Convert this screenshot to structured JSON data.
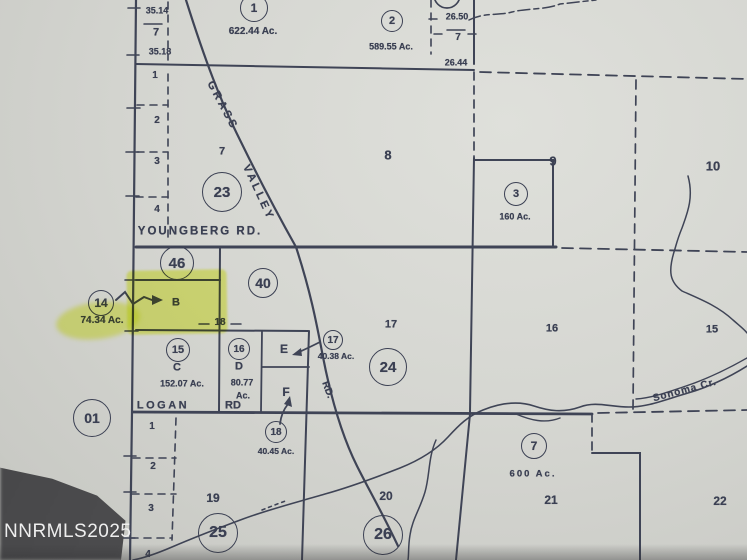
{
  "watermark": "NNRMLS2025",
  "colors": {
    "paper": "#d5d6d1",
    "ink": "#3b4053",
    "highlight": "#e9f63e",
    "photo_corner": "#4f4f51",
    "watermark_text": "#eeeeee"
  },
  "map": {
    "roads": {
      "youngberg": "YOUNGBERG  RD.",
      "grass": "GRASS",
      "valley": "VALLEY",
      "valley_rd": "RD.",
      "logan": "LOGAN",
      "logan_rd": "RD"
    },
    "creek_label": "Sonoma Cr.",
    "sections": {
      "s7": "7",
      "s8": "8",
      "s9": "9",
      "s10": "10",
      "s15": "15",
      "s16": "16",
      "s17": "17",
      "s19": "19",
      "s20": "20",
      "s21": "21",
      "s22": "22"
    },
    "circled": {
      "c1": "1",
      "c2": "2",
      "c3": "3",
      "c7": "7",
      "c01": "01",
      "c14": "14",
      "c15": "15",
      "c16": "16",
      "c17": "17",
      "c18": "18",
      "c23": "23",
      "c24": "24",
      "c25": "25",
      "c26": "26",
      "c40": "40",
      "c46": "46"
    },
    "acreage": {
      "a622": "622.44 Ac.",
      "a589": "589.55 Ac.",
      "a160": "160 Ac.",
      "a74": "74.34 Ac.",
      "a152": "152.07 Ac.",
      "a80": "80.77",
      "a80u": "Ac.",
      "a4038": "40.38 Ac.",
      "a4045": "40.45 Ac.",
      "a600": "600 Ac."
    },
    "lot_dims": {
      "d3514": "35.14",
      "d7top": "7",
      "d3518": "35.18",
      "d2650": "26.50",
      "d7r": "7",
      "d2644": "26.44",
      "edge18": "18"
    },
    "lot_numbers": {
      "u1": "1",
      "u2": "2",
      "u3": "3",
      "u4": "4",
      "w1": "1",
      "w2": "2",
      "w3": "3",
      "w4": "4"
    },
    "parcels": {
      "pB": "B",
      "pC": "C",
      "pD": "D",
      "pE": "E",
      "pF": "F"
    }
  }
}
